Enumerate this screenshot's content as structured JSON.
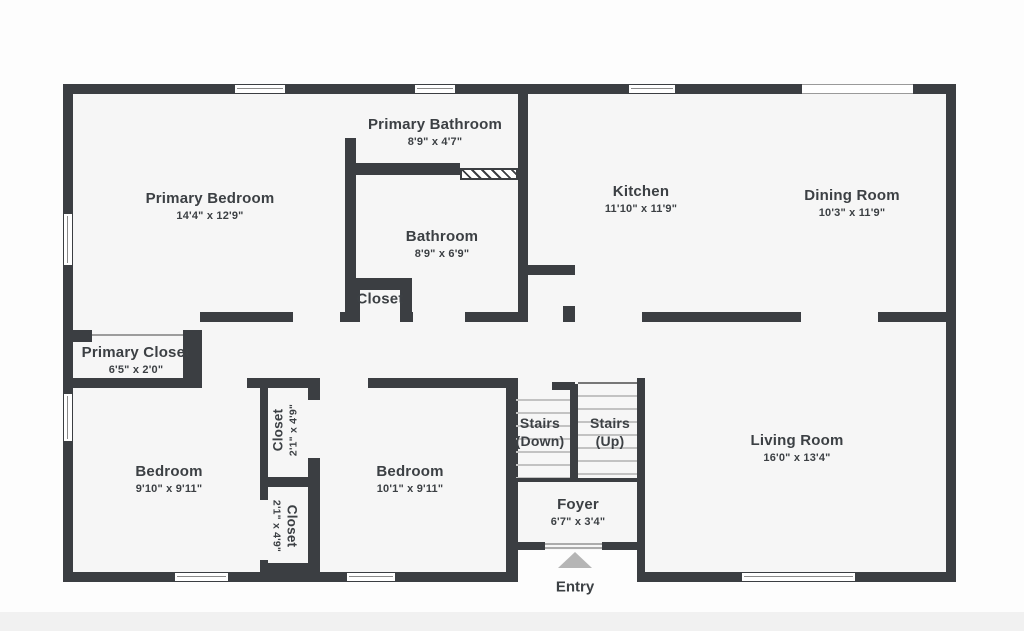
{
  "floorplan": {
    "rooms": {
      "primary_bedroom": {
        "label": "Primary Bedroom",
        "dims": "14'4\" x 12'9\""
      },
      "primary_bathroom": {
        "label": "Primary Bathroom",
        "dims": "8'9\" x 4'7\""
      },
      "bathroom": {
        "label": "Bathroom",
        "dims": "8'9\" x 6'9\""
      },
      "hall_closet": {
        "label": "Closet"
      },
      "primary_closet": {
        "label": "Primary Closet",
        "dims": "6'5\" x 2'0\""
      },
      "kitchen": {
        "label": "Kitchen",
        "dims": "11'10\" x 11'9\""
      },
      "dining_room": {
        "label": "Dining Room",
        "dims": "10'3\" x 11'9\""
      },
      "bedroom_1": {
        "label": "Bedroom",
        "dims": "9'10\" x 9'11\""
      },
      "bedroom_2": {
        "label": "Bedroom",
        "dims": "10'1\" x 9'11\""
      },
      "closet_1": {
        "label": "Closet",
        "dims": "2'1\" x 4'9\""
      },
      "closet_2": {
        "label": "Closet",
        "dims": "2'1\" x 4'9\""
      },
      "stairs_down": {
        "label": "Stairs",
        "sub": "(Down)"
      },
      "stairs_up": {
        "label": "Stairs",
        "sub": "(Up)"
      },
      "foyer": {
        "label": "Foyer",
        "dims": "6'7\" x 3'4\""
      },
      "living_room": {
        "label": "Living Room",
        "dims": "16'0\" x 13'4\""
      }
    },
    "entry_label": "Entry",
    "colors": {
      "wall": "#3b3e42",
      "floor": "#f6f6f6",
      "text": "#3c4044",
      "stair_tread": "#c2c2c2",
      "entry_arrow": "#b5b5b5"
    }
  }
}
